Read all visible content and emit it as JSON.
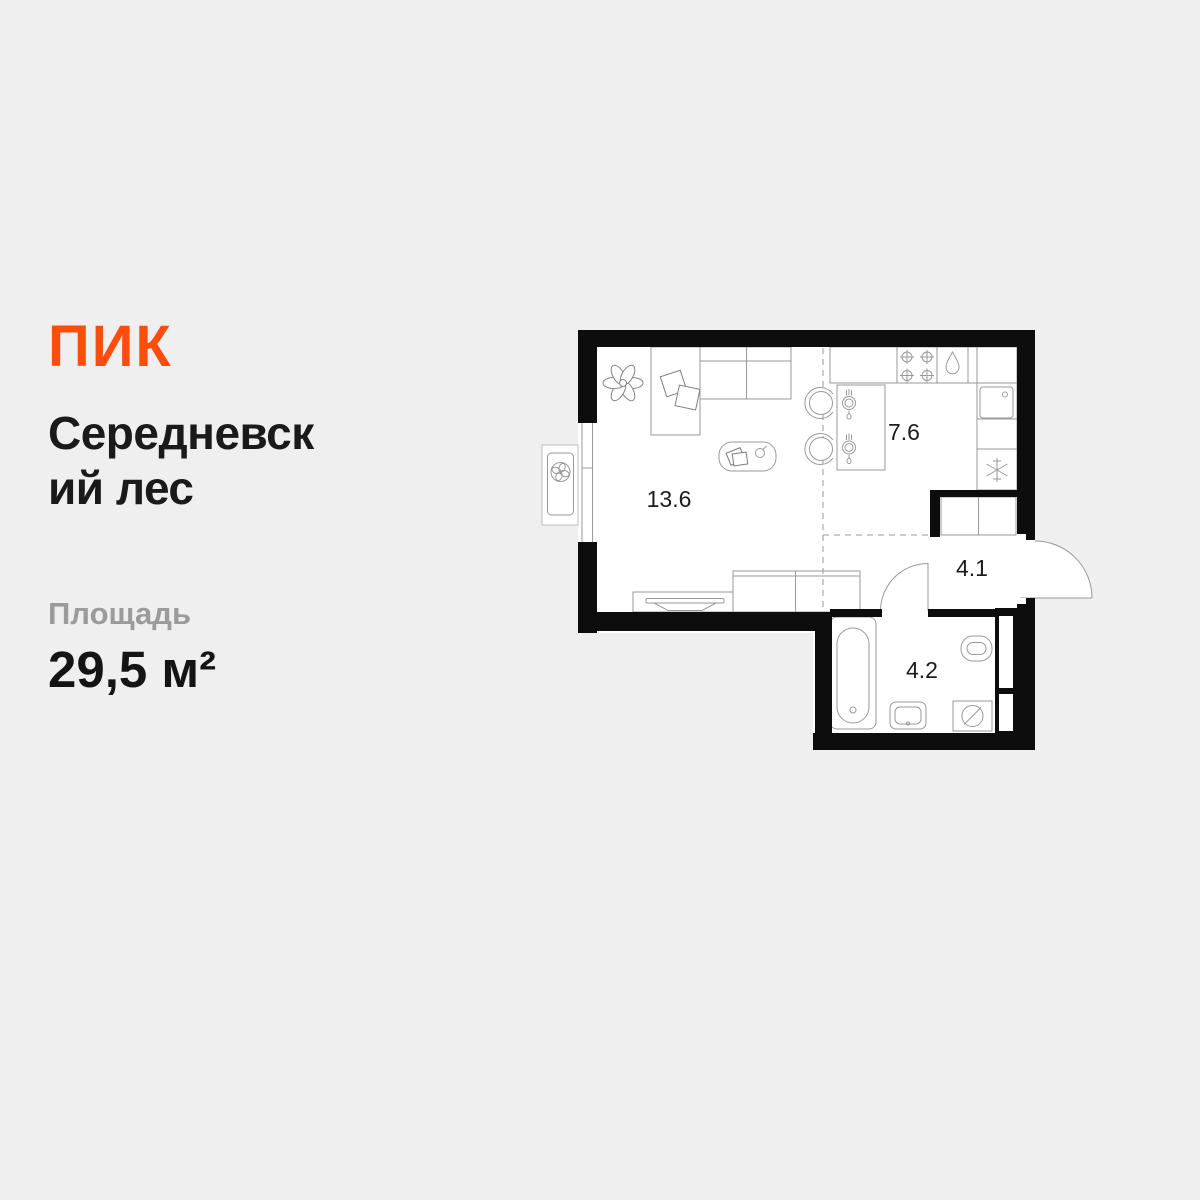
{
  "background_color": "#EFEFEF",
  "brand": {
    "logo": "ПИК",
    "color": "#FB4E0D"
  },
  "project": {
    "title_lines": [
      "Середневск",
      "ий лес"
    ]
  },
  "area": {
    "label": "Площадь",
    "value": "29,5 м²"
  },
  "floor_plan": {
    "wall_color": "#0D0D0D",
    "line_color": "#9A9A9A",
    "room_fill": "#FFFFFF",
    "rooms": [
      {
        "id": "living-room",
        "area": "13.6"
      },
      {
        "id": "kitchen",
        "area": "7.6"
      },
      {
        "id": "hallway",
        "area": "4.1"
      },
      {
        "id": "bathroom",
        "area": "4.2"
      }
    ],
    "icons": [
      "plant-icon",
      "sofa",
      "pillow-icon",
      "coffee-table",
      "book-icon",
      "cup-icon",
      "tv-icon",
      "tv-stand",
      "media-cabinet",
      "bar-counter",
      "place-setting-icon",
      "bar-stool-icon",
      "stove-burner-icon",
      "water-drop-icon",
      "kitchen-sink-icon",
      "snowflake-icon",
      "wardrobe",
      "window",
      "air-conditioner-fan-icon",
      "entrance-door",
      "bathroom-door",
      "bathtub-icon",
      "washbasin-icon",
      "toilet-icon",
      "washing-machine-icon"
    ]
  }
}
